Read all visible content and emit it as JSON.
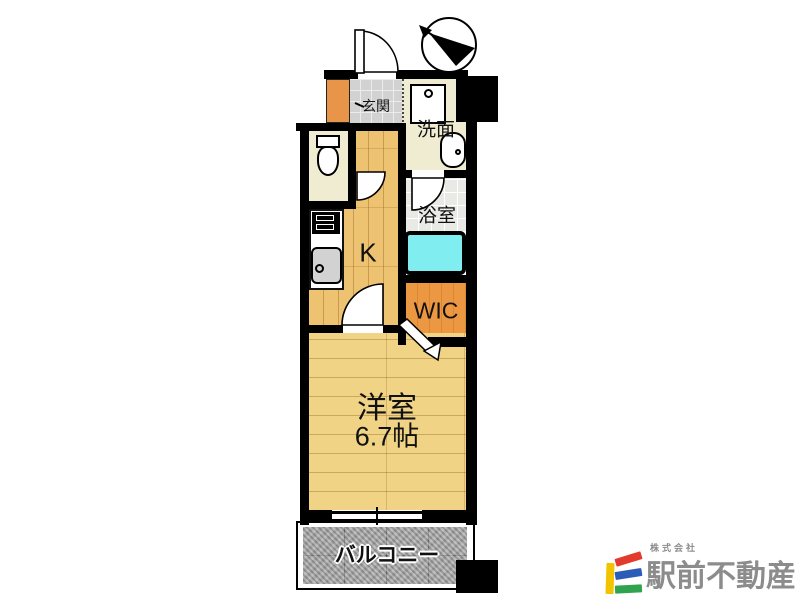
{
  "floorplan": {
    "rooms": {
      "genkan": {
        "label": "玄関"
      },
      "senmen": {
        "label": "洗面"
      },
      "bathroom": {
        "label": "浴室"
      },
      "kitchen": {
        "label": "K"
      },
      "wic": {
        "label": "WIC"
      },
      "western_room": {
        "label": "洋室",
        "size": "6.7帖"
      },
      "balcony": {
        "label": "バルコニー"
      }
    },
    "colors": {
      "wall": "#000000",
      "kitchen_floor": "#edc271",
      "western_room_floor": "#f0d384",
      "wic_floor": "#ec9742",
      "bathtub": "#80eef0",
      "cream_floor": "#f0ecd2",
      "genkan_tile": "#d2d2d2",
      "bath_tile": "#e9e9e6",
      "balcony_floor": "#a8a8a8",
      "shoebox": "#e8954a"
    }
  },
  "logo": {
    "company_prefix": "株式会社",
    "company_name": "駅前不動産",
    "colors": {
      "yellow": "#f2c400",
      "red": "#e23b2e",
      "blue": "#2b5cb8",
      "green": "#2fa34d",
      "text": "#8c8c8c"
    }
  }
}
